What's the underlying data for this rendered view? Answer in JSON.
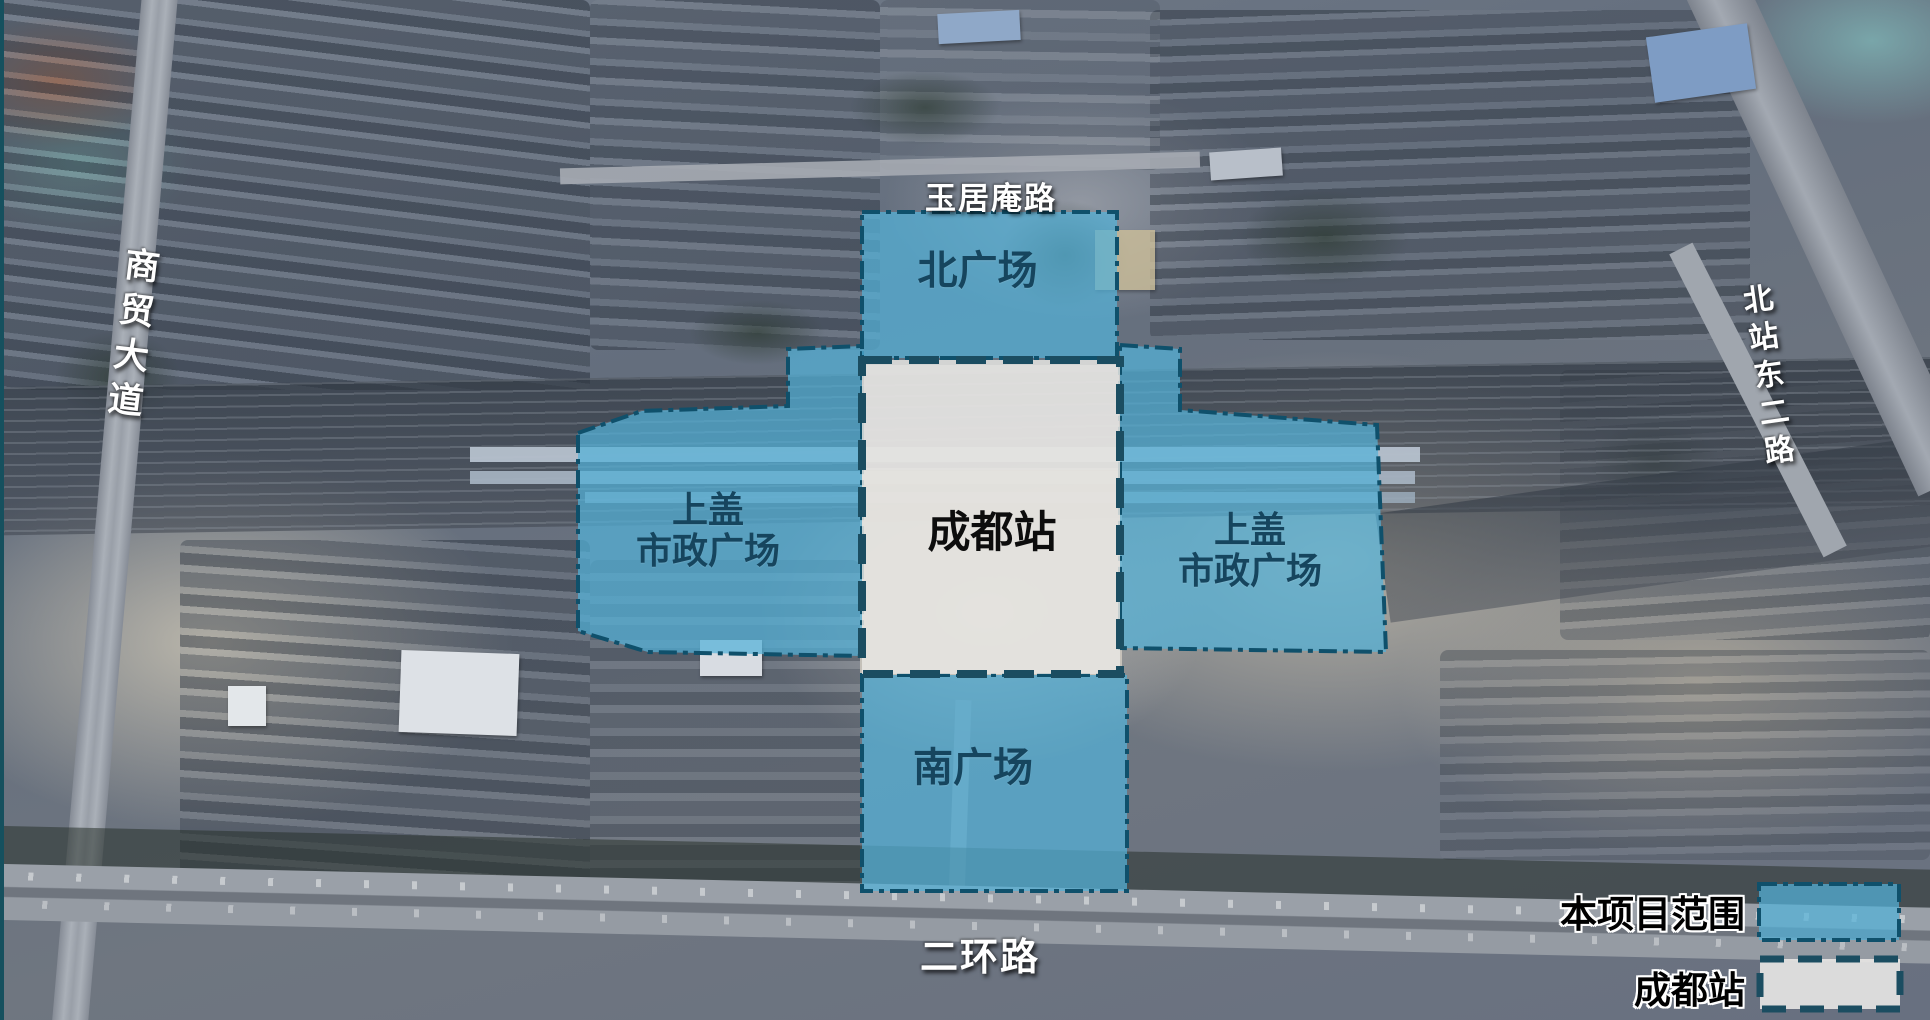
{
  "colors": {
    "project_area_fill": "#53b1d8",
    "area_border": "#0f506b",
    "station_fill": "#e8e7e4",
    "station_border": "#1b4d61",
    "area_label_color": "#16455e",
    "station_label_color": "#0d0d0d"
  },
  "areas": {
    "north_plaza": {
      "label": "北广场"
    },
    "south_plaza": {
      "label": "南广场"
    },
    "west_deck_plaza": {
      "line1": "上盖",
      "line2": "市政广场"
    },
    "east_deck_plaza": {
      "line1": "上盖",
      "line2": "市政广场"
    },
    "station": {
      "label": "成都站"
    }
  },
  "roads": {
    "yujuan_an_road": "玉居庵路",
    "shangmao_avenue": "商贸大道",
    "beizhan_east_2nd_road": "北站东二路",
    "erhuan_road": "二环路"
  },
  "legend": {
    "project_scope": "本项目范围",
    "station": "成都站"
  }
}
